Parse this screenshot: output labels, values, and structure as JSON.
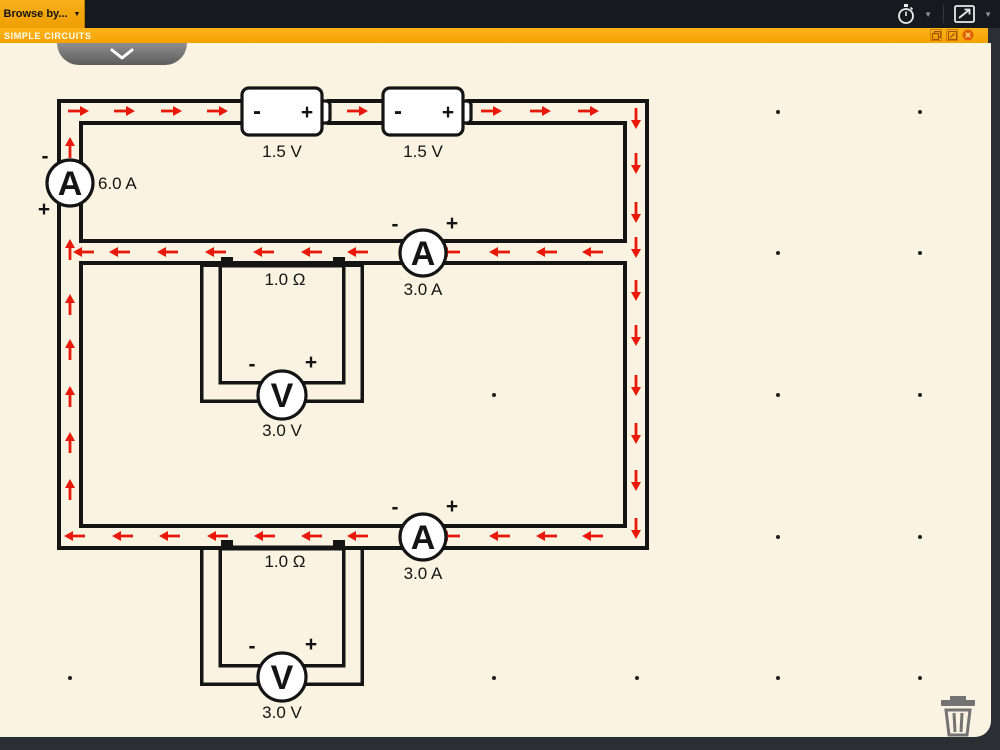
{
  "topbar": {
    "browse_label": "Browse by...",
    "browse_caret": "▼"
  },
  "titlebar": {
    "title": "SIMPLE CIRCUITS"
  },
  "circuit": {
    "colors": {
      "wire": "#141414",
      "arrow": "#e8190b",
      "canvas": "#faf3e1",
      "dot": "#1f1f1f"
    },
    "batteries": [
      {
        "minus": "-",
        "plus": "+",
        "label": "1.5 V"
      },
      {
        "minus": "-",
        "plus": "+",
        "label": "1.5 V"
      }
    ],
    "ammeter_main": {
      "letter": "A",
      "minus": "-",
      "plus": "+",
      "reading": "6.0 A"
    },
    "ammeter_mid": {
      "letter": "A",
      "minus": "-",
      "plus": "+",
      "reading": "3.0 A"
    },
    "ammeter_bottom": {
      "letter": "A",
      "minus": "-",
      "plus": "+",
      "reading": "3.0 A"
    },
    "resistor_mid": {
      "label": "1.0 Ω"
    },
    "resistor_bottom": {
      "label": "1.0 Ω"
    },
    "voltmeter_mid": {
      "letter": "V",
      "minus": "-",
      "plus": "+",
      "reading": "3.0 V"
    },
    "voltmeter_bottom": {
      "letter": "V",
      "minus": "-",
      "plus": "+",
      "reading": "3.0 V"
    },
    "current_arrows": {
      "right_top_wire": {
        "y": 111,
        "x": [
          78,
          124,
          171,
          217,
          357,
          491,
          540,
          588
        ]
      },
      "down_right_wire": {
        "x": 636,
        "y": [
          118,
          163,
          212,
          247,
          290,
          335,
          385,
          433,
          480,
          528
        ]
      },
      "left_middle_wire": {
        "y": 252,
        "x": [
          84,
          120,
          168,
          216,
          264,
          312,
          358,
          450,
          500,
          547,
          593
        ]
      },
      "left_bottom_wire": {
        "y": 536,
        "x": [
          75,
          123,
          170,
          218,
          265,
          312,
          358,
          450,
          500,
          547,
          593
        ]
      },
      "up_left_wire": {
        "x": 70,
        "y": [
          148,
          250,
          305,
          350,
          397,
          443,
          490
        ]
      }
    },
    "grid_dots": [
      [
        778,
        112
      ],
      [
        920,
        112
      ],
      [
        778,
        253
      ],
      [
        920,
        253
      ],
      [
        494,
        395
      ],
      [
        778,
        395
      ],
      [
        920,
        395
      ],
      [
        778,
        537
      ],
      [
        920,
        537
      ],
      [
        70,
        678
      ],
      [
        494,
        678
      ],
      [
        637,
        678
      ],
      [
        778,
        678
      ],
      [
        920,
        678
      ]
    ]
  }
}
